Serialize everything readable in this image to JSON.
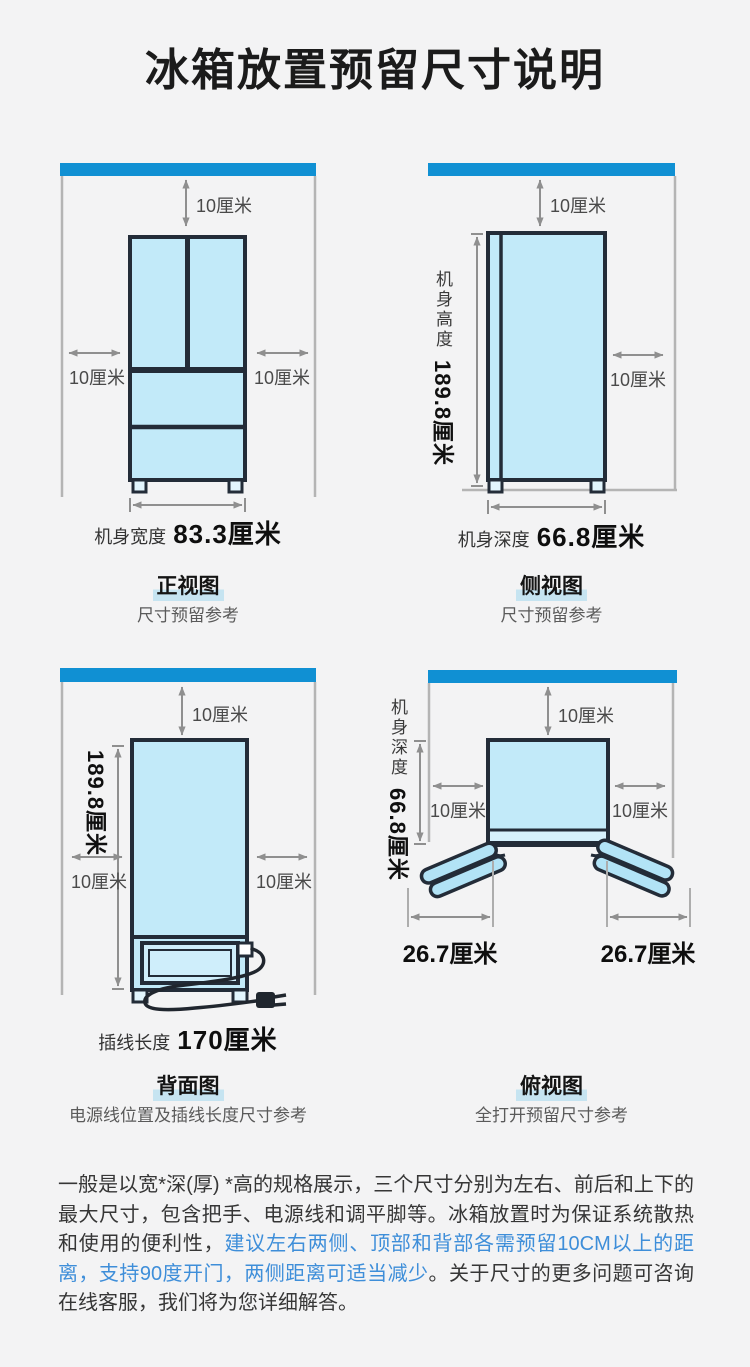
{
  "page": {
    "title": "冰箱放置预留尺寸说明"
  },
  "colors": {
    "accent_blue": "#1090d3",
    "fridge_fill": "#c2eaf9",
    "outline_ink": "#232c38",
    "label_highlight": "#c6e4f1",
    "text_blue": "#3e8ed9",
    "dim_gray": "#8f8f8f"
  },
  "views": {
    "front": {
      "name": "正视图",
      "caption": "尺寸预留参考",
      "clearance_top": "10厘米",
      "clearance_left": "10厘米",
      "clearance_right": "10厘米",
      "width_label": "机身宽度",
      "width_value": "83.3厘米"
    },
    "side": {
      "name": "侧视图",
      "caption": "尺寸预留参考",
      "clearance_top": "10厘米",
      "clearance_right": "10厘米",
      "height_label": "机身高度",
      "height_value": "189.8厘米",
      "depth_label": "机身深度",
      "depth_value": "66.8厘米"
    },
    "back": {
      "name": "背面图",
      "caption": "电源线位置及插线长度尺寸参考",
      "clearance_top": "10厘米",
      "clearance_left": "10厘米",
      "clearance_right": "10厘米",
      "height_value": "189.8厘米",
      "cord_label": "插线长度",
      "cord_value": "170厘米"
    },
    "top": {
      "name": "俯视图",
      "caption": "全打开预留尺寸参考",
      "clearance_top": "10厘米",
      "clearance_left": "10厘米",
      "clearance_right": "10厘米",
      "depth_label": "机身深度",
      "depth_value": "66.8厘米",
      "door_left_value": "26.7厘米",
      "door_right_value": "26.7厘米"
    }
  },
  "footnote": {
    "part1": "一般是以宽*深(厚) *高的规格展示，三个尺寸分别为左右、前后和上下的最大尺寸，包含把手、电源线和调平脚等。冰箱放置时为保证系统散热和使用的便利性，",
    "highlight": "建议左右两侧、顶部和背部各需预留10CM以上的距离，支持90度开门，两侧距离可适当减少",
    "part2": "。关于尺寸的更多问题可咨询在线客服，我们将为您详细解答。"
  }
}
